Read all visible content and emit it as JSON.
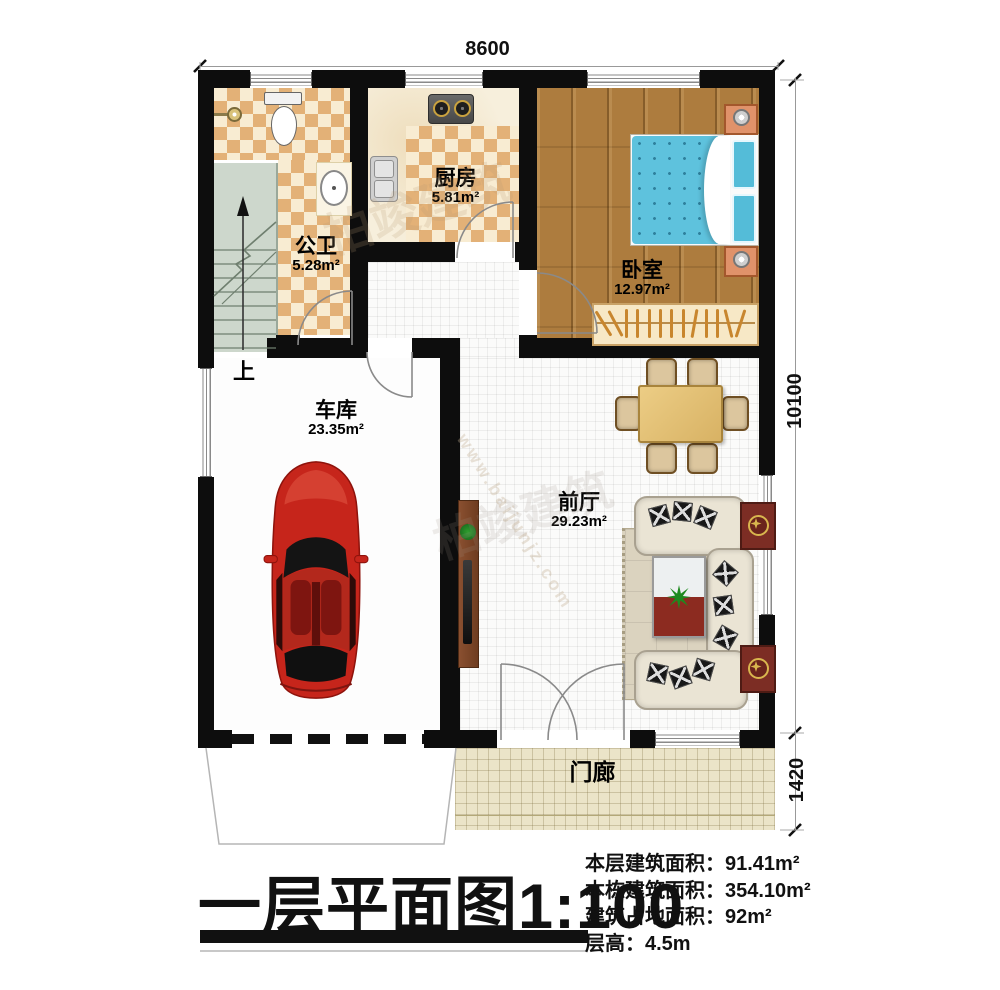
{
  "dimensions": {
    "top": "8600",
    "right_main": "10100",
    "right_porch": "1420"
  },
  "rooms": {
    "bathroom": {
      "name": "公卫",
      "area": "5.28m²"
    },
    "kitchen": {
      "name": "厨房",
      "area": "5.81m²"
    },
    "bedroom": {
      "name": "卧室",
      "area": "12.97m²"
    },
    "garage": {
      "name": "车库",
      "area": "23.35m²"
    },
    "hall": {
      "name": "前厅",
      "area": "29.23m²"
    },
    "porch": {
      "name": "门廊"
    }
  },
  "stairs": {
    "up_label": "上"
  },
  "title_block": {
    "title": "一层平面图1:100",
    "info": [
      "本层建筑面积：91.41m²",
      "本栋建筑面积：354.10m²",
      "建筑占地面积：92m²",
      "层高：4.5m"
    ]
  },
  "watermark": {
    "brand": "柏竣建筑",
    "url": "www.baijunjz.com"
  },
  "colors": {
    "wall": "#0d0d0d",
    "tile_dark": "#e3b177",
    "tile_light": "#f8ecd2",
    "wood_floor": "#ad7c3e",
    "bed_blue": "#5ec2dd",
    "car_red": "#c6251b",
    "stairs": "#cdd7cc",
    "porch": "#ebe4c8",
    "side_table": "#7c2d24"
  }
}
